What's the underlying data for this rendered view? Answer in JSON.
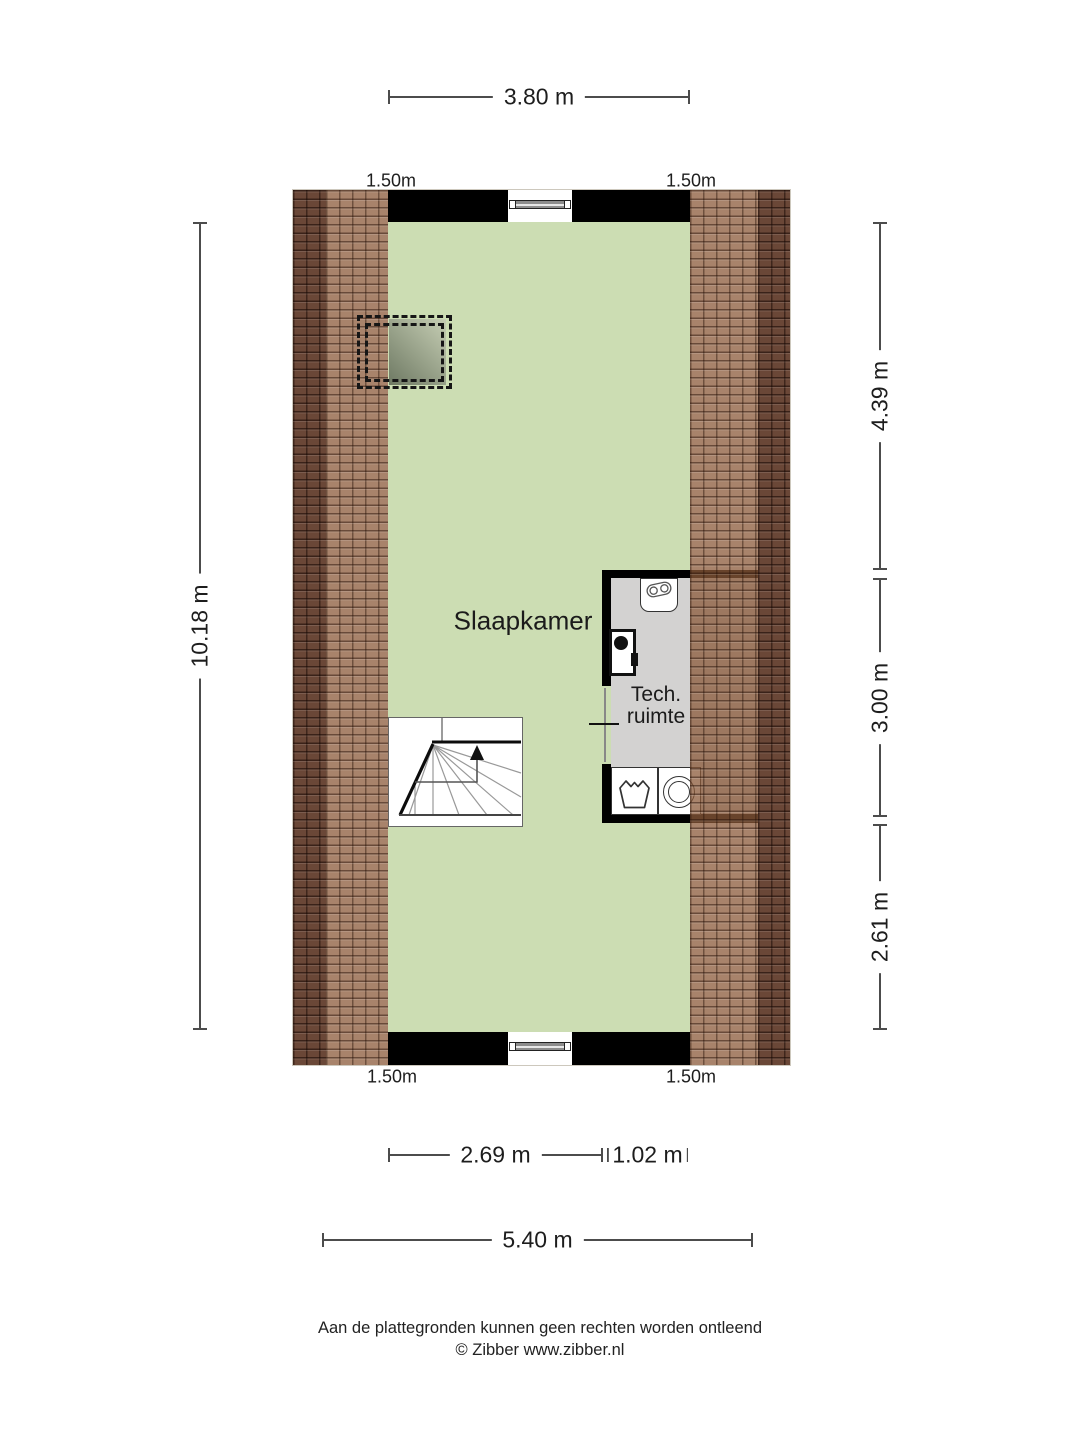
{
  "plan": {
    "room_labels": {
      "bedroom": "Slaapkamer",
      "tech_line1": "Tech.",
      "tech_line2": "ruimte"
    },
    "dimensions": {
      "top_width": "3.80 m",
      "left_height": "10.18 m",
      "right_upper": "4.39 m",
      "right_middle": "3.00 m",
      "right_lower": "2.61 m",
      "bottom_left_inner": "2.69 m",
      "bottom_right_inner": "1.02 m",
      "bottom_total": "5.40 m",
      "headroom_top_left": "1.50m",
      "headroom_top_right": "1.50m",
      "headroom_bottom_left": "1.50m",
      "headroom_bottom_right": "1.50m"
    },
    "icons": {
      "boiler-icon": "cv-boiler two-circle symbol",
      "ventilation-unit-icon": "black box with dot (mechanical ventilation)",
      "washing-machine-icon": "laundry tub glyph",
      "dryer-icon": "drum circle glyph",
      "skylight-icon": "dashed roof window",
      "window-icon": "frame bar with end blocks",
      "stairs-up-arrow-icon": "up arrow"
    }
  },
  "footer": {
    "line1": "Aan de plattegronden kunnen geen rechten worden ontleend",
    "line2": "© Zibber www.zibber.nl"
  },
  "colors": {
    "floor-green": "#ccddb3",
    "tech-floor": "#d3d2d1",
    "tile-dark": "#6a4737",
    "tile-light": "rgba(139,90,57,0.75)",
    "wall": "#000000",
    "dim-line": "#4c4c4c"
  }
}
